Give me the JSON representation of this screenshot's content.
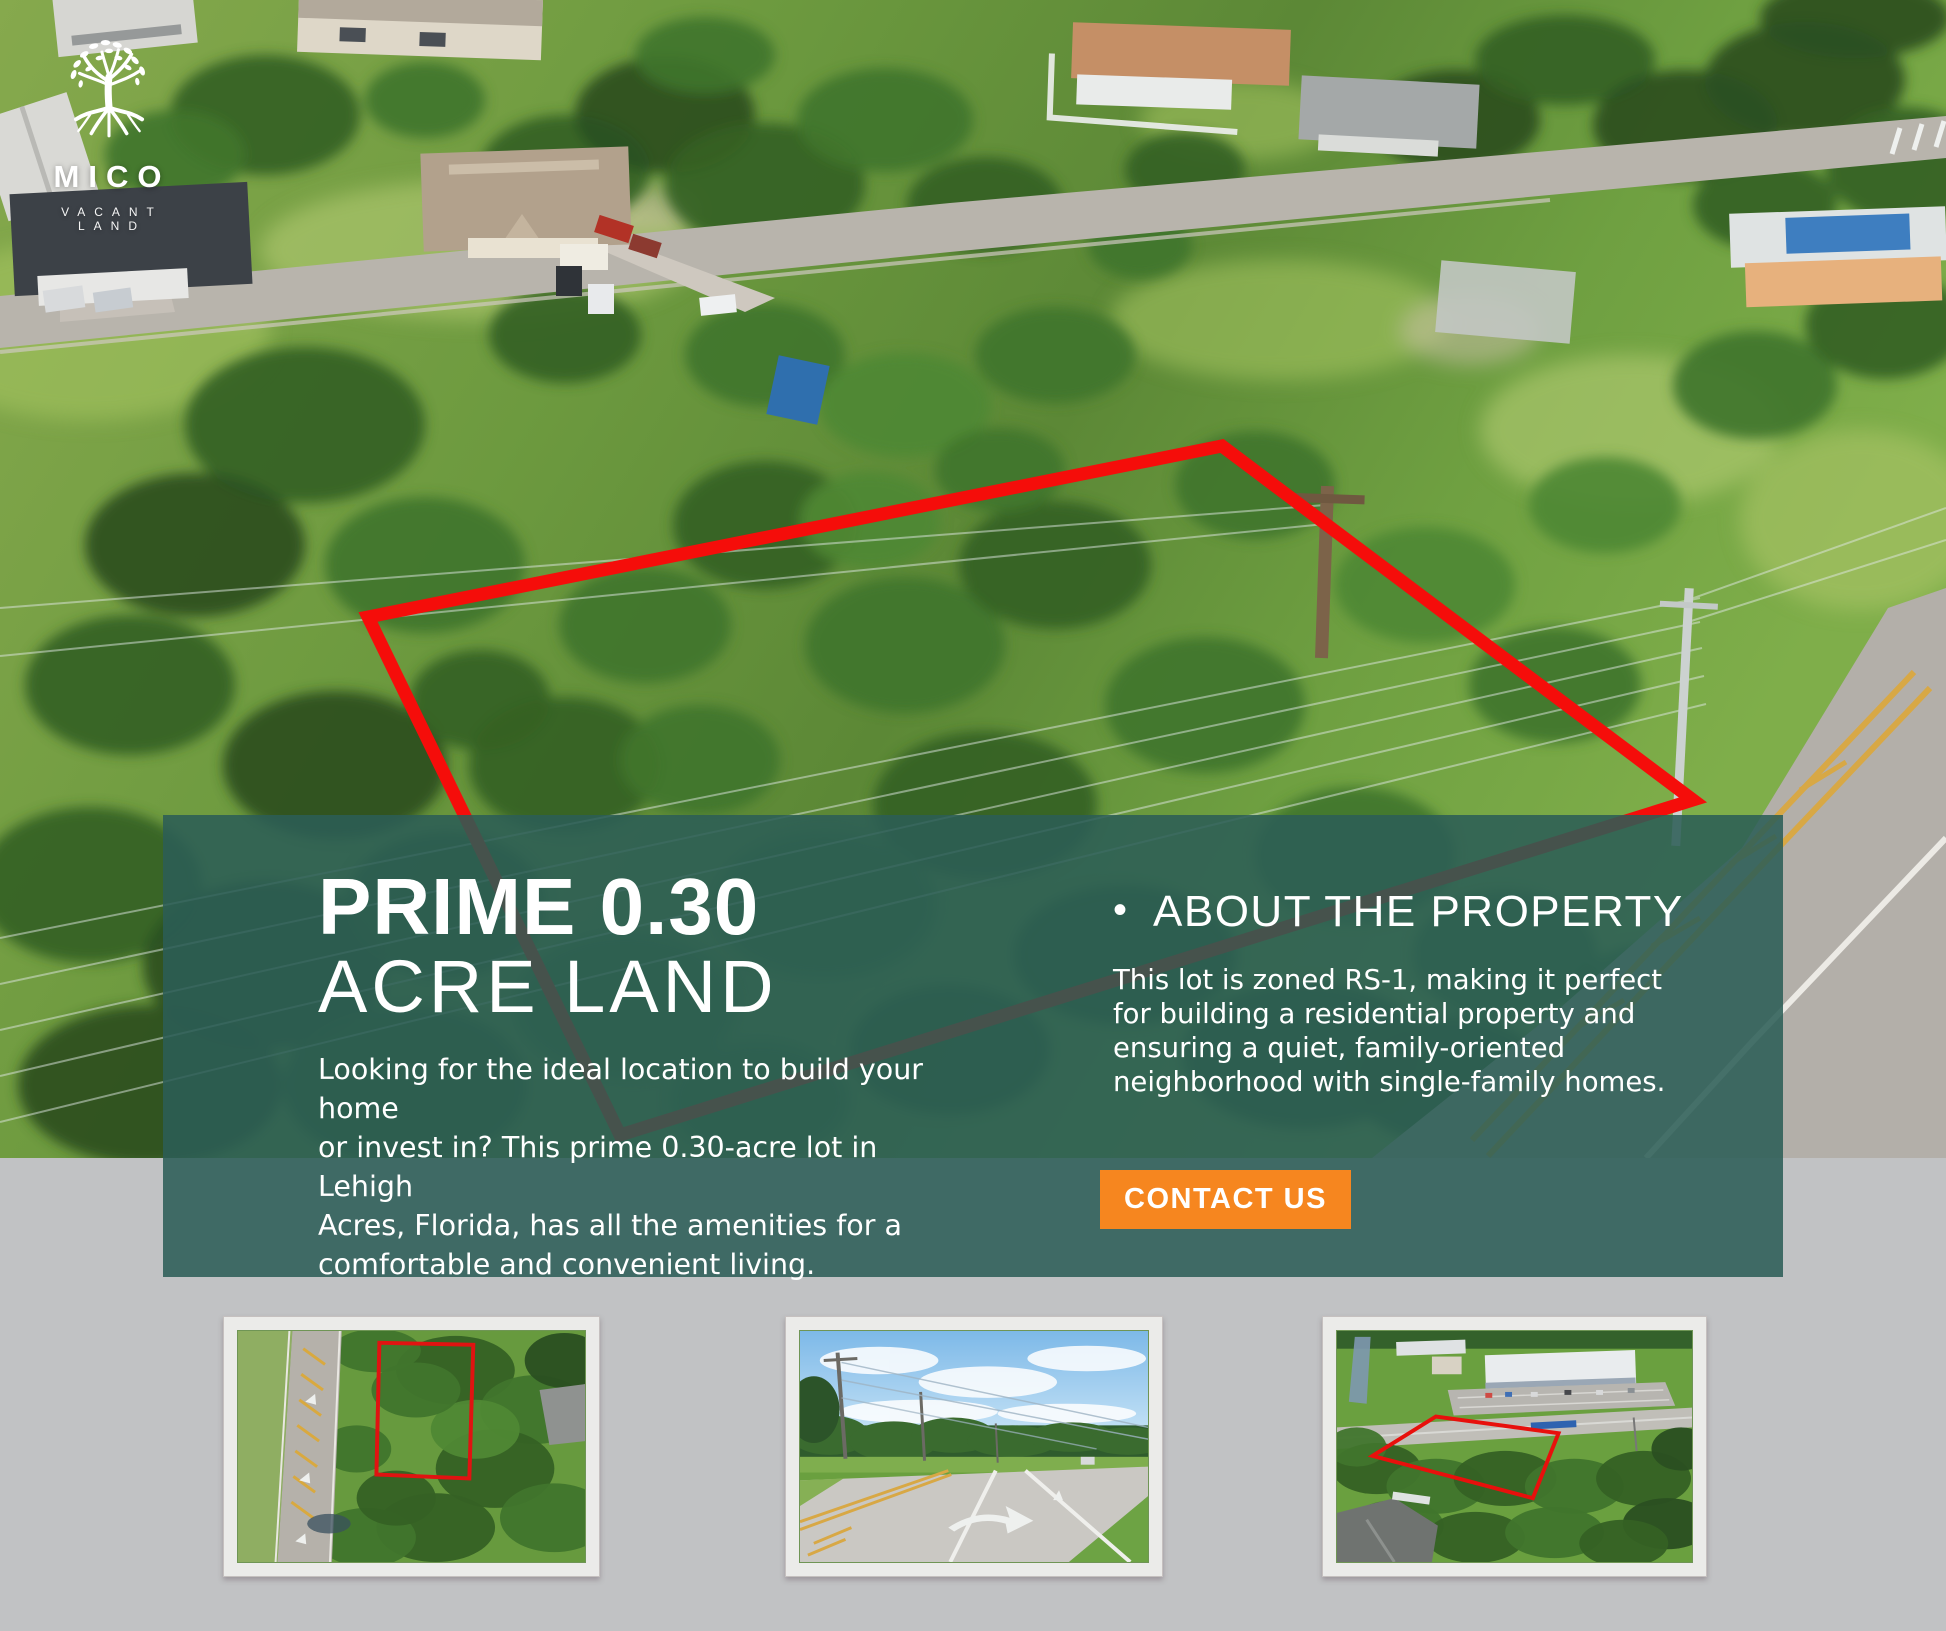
{
  "brand": {
    "name": "MICO",
    "tagline": "VACANT LAND",
    "logo_icon": "tree-with-roots-icon"
  },
  "hero": {
    "headline_line1": "PRIME 0.30",
    "headline_line2": "ACRE LAND",
    "description": "Looking for the ideal location to build your home\nor invest in? This prime 0.30-acre lot in Lehigh\nAcres, Florida, has all the amenities for a\ncomfortable and convenient living."
  },
  "about": {
    "bullet": "•",
    "title": "ABOUT THE PROPERTY",
    "body": "This lot is zoned RS-1, making it perfect\nfor building a residential property and\n ensuring a quiet, family-oriented\nneighborhood with single-family homes."
  },
  "cta": {
    "label": "CONTACT US"
  },
  "colors": {
    "panel_teal": "rgba(44,93,86,.87)",
    "cta_orange": "#F6861F",
    "boundary_red": "#F50D0A",
    "page_gray": "#C1C2C4"
  },
  "thumbnails": [
    {
      "label": "aerial top-down view of lot beside road"
    },
    {
      "label": "street view of road by the lot"
    },
    {
      "label": "aerial oblique view of lot near school"
    }
  ]
}
